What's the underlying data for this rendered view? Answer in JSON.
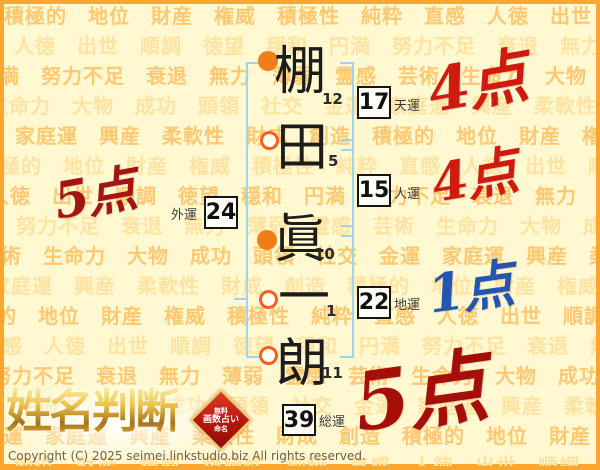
{
  "background": {
    "page_bg": "#fff8d0",
    "border_color": "#fda62e",
    "word_color_a": "#ffc873",
    "word_color_b": "#ffe3a2",
    "words": [
      "積極的",
      "地位",
      "財産",
      "権威",
      "積極性",
      "純粋",
      "直感",
      "人徳",
      "出世",
      "順調",
      "徳望",
      "穏和",
      "円満",
      "努力不足",
      "衰退",
      "無力",
      "薄弱",
      "霊感",
      "芸術",
      "生命力",
      "大物",
      "成功",
      "頭領",
      "社交",
      "金運",
      "家庭運",
      "興産",
      "柔軟性",
      "財成",
      "創造"
    ]
  },
  "name": {
    "characters": [
      {
        "char": "棚",
        "strokes": "12",
        "bullet": "filled"
      },
      {
        "char": "田",
        "strokes": "5",
        "bullet": "hollow"
      },
      {
        "char": "眞",
        "strokes": "10",
        "bullet": "filled"
      },
      {
        "char": "一",
        "strokes": "1",
        "bullet": "hollow"
      },
      {
        "char": "朗",
        "strokes": "11",
        "bullet": "hollow"
      }
    ]
  },
  "fortunes": {
    "ten": {
      "value": "17",
      "label": "天運"
    },
    "jin": {
      "value": "15",
      "label": "人運"
    },
    "gai": {
      "value": "24",
      "label": "外運"
    },
    "chi": {
      "value": "22",
      "label": "地運"
    },
    "sou": {
      "value": "39",
      "label": "総運"
    }
  },
  "scores": {
    "ten": {
      "text": "4点",
      "color": "#cf1a0d"
    },
    "jin": {
      "text": "4点",
      "color": "#cf1a0d"
    },
    "gai": {
      "text": "5点",
      "color": "#a31510"
    },
    "chi": {
      "text": "1点",
      "color": "#2356b0"
    },
    "sou": {
      "text": "5点",
      "color": "#a50f0a"
    }
  },
  "logo": {
    "title": "姓名判断",
    "seal_lines": [
      "無料",
      "画数占い",
      "命名"
    ]
  },
  "footer": {
    "copyright": "Copyright (C) 2025 seimei.linkstudio.biz All rights reserved."
  }
}
